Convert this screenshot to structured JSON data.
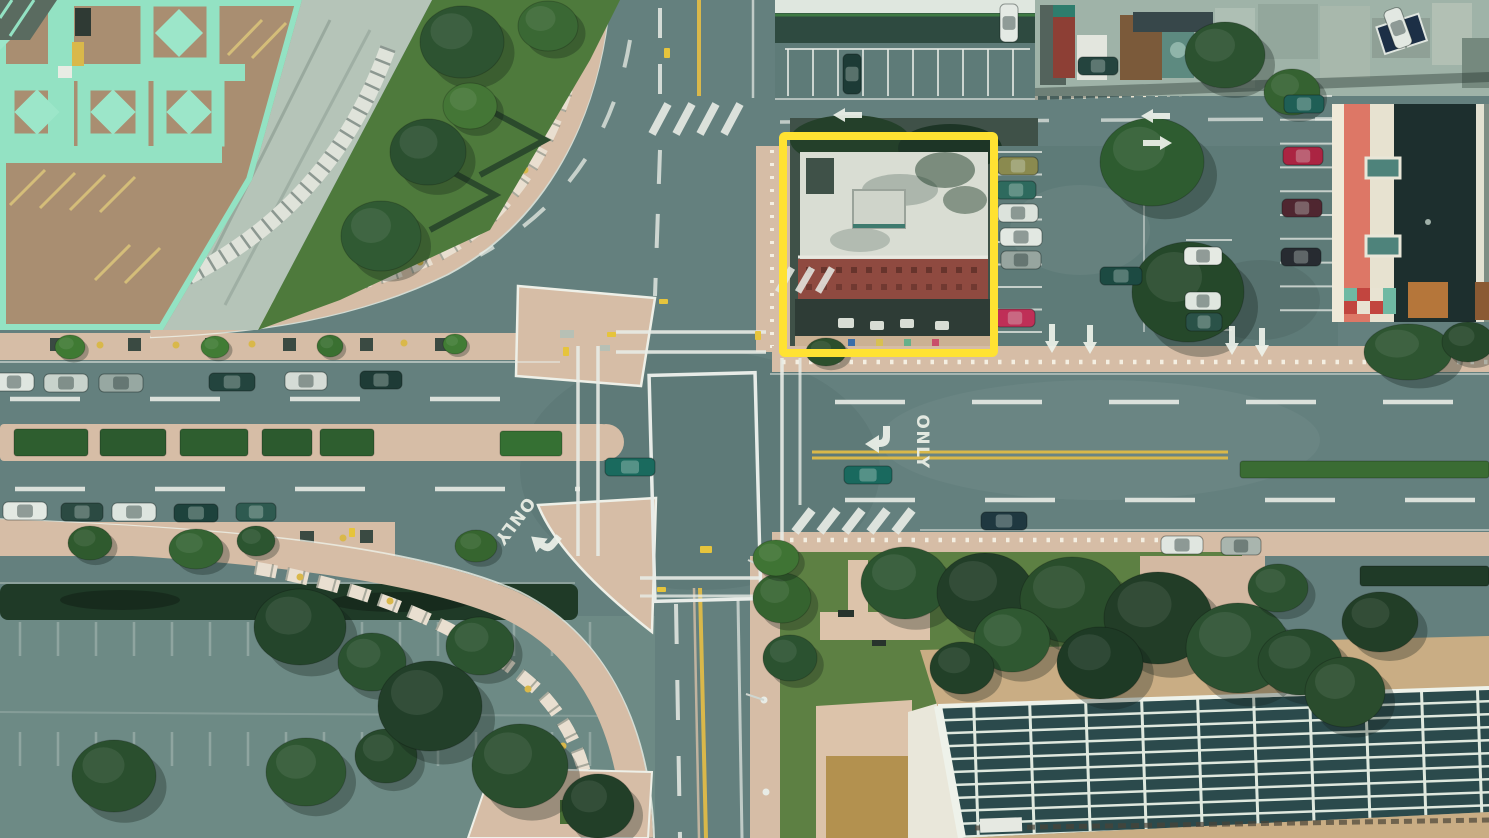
{
  "scene": {
    "description": "Aerial top-down drone photograph of a city street intersection; a building on the north-east corner is outlined with a yellow highlight rectangle",
    "annotation": {
      "label": "highlighted-building",
      "color": "#ffe232",
      "x": 783,
      "y": 136,
      "width": 211,
      "height": 217,
      "stroke_width": 8
    },
    "road_markings": {
      "only_east": "ONLY",
      "only_southwest": "ONLY"
    },
    "palette": {
      "road": "#64807e",
      "road_light": "#6d8a85",
      "asphalt_lot": "#5e7b78",
      "sidewalk": "#d6bda6",
      "deck_tan": "#a98e71",
      "deck_mint": "#93e2c3",
      "lawn": "#5d8043",
      "hedge_dark": "#1f3a27",
      "panel_roof": "#2b4a4c",
      "panel_grid": "#dfe9df",
      "brick_red": "#8f4a40",
      "coral": "#dd7766",
      "cream": "#e7e2d0",
      "dark_roof": "#1d2f2e",
      "white_roof": "#d9ddd3",
      "yellow_line": "#d9b84a",
      "white_line": "#edf1e8"
    },
    "cars": [
      {
        "x": 14,
        "y": 382,
        "a": 0,
        "c": "#dfe6e0",
        "l": 40
      },
      {
        "x": 66,
        "y": 383,
        "a": 0,
        "c": "#c8d3cc",
        "l": 44
      },
      {
        "x": 121,
        "y": 383,
        "a": 0,
        "c": "#97a8a2",
        "l": 44
      },
      {
        "x": 232,
        "y": 382,
        "a": 0,
        "c": "#23443e",
        "l": 46
      },
      {
        "x": 306,
        "y": 381,
        "a": 0,
        "c": "#d5dcd6",
        "l": 42
      },
      {
        "x": 381,
        "y": 380,
        "a": 0,
        "c": "#1e3b36",
        "l": 42
      },
      {
        "x": 25,
        "y": 511,
        "a": 0,
        "c": "#e3e9e3",
        "l": 44
      },
      {
        "x": 82,
        "y": 512,
        "a": 0,
        "c": "#2b4a42",
        "l": 42
      },
      {
        "x": 134,
        "y": 512,
        "a": 0,
        "c": "#dde5df",
        "l": 44
      },
      {
        "x": 196,
        "y": 513,
        "a": 0,
        "c": "#1d423c",
        "l": 44
      },
      {
        "x": 256,
        "y": 512,
        "a": 0,
        "c": "#2e5a50",
        "l": 40
      },
      {
        "x": 630,
        "y": 467,
        "a": 0,
        "c": "#1a6a5e",
        "l": 50
      },
      {
        "x": 868,
        "y": 475,
        "a": 0,
        "c": "#19695e",
        "l": 48
      },
      {
        "x": 1004,
        "y": 521,
        "a": 0,
        "c": "#1f3840",
        "l": 46
      },
      {
        "x": 1182,
        "y": 545,
        "a": 0,
        "c": "#e0e6e0",
        "l": 42
      },
      {
        "x": 1241,
        "y": 546,
        "a": 0,
        "c": "#a9b5ae",
        "l": 40
      },
      {
        "x": 852,
        "y": 74,
        "a": 90,
        "c": "#1d3b36",
        "l": 40
      },
      {
        "x": 1009,
        "y": 23,
        "a": 90,
        "c": "#e4eae4",
        "l": 38
      },
      {
        "x": 1098,
        "y": 66,
        "a": 0,
        "c": "#24443e",
        "l": 40
      },
      {
        "x": 1398,
        "y": 28,
        "a": 70,
        "c": "#e2e8e2",
        "l": 40
      },
      {
        "x": 1018,
        "y": 166,
        "a": 0,
        "c": "#8a8a4f",
        "l": 40
      },
      {
        "x": 1016,
        "y": 190,
        "a": 0,
        "c": "#2e6a5e",
        "l": 40
      },
      {
        "x": 1018,
        "y": 213,
        "a": 0,
        "c": "#dce3dc",
        "l": 40
      },
      {
        "x": 1021,
        "y": 237,
        "a": 0,
        "c": "#e2e8e2",
        "l": 42
      },
      {
        "x": 1021,
        "y": 260,
        "a": 0,
        "c": "#97a59f",
        "l": 40
      },
      {
        "x": 1015,
        "y": 318,
        "a": 0,
        "c": "#bf2f57",
        "l": 40
      },
      {
        "x": 1121,
        "y": 276,
        "a": 0,
        "c": "#1c4a42",
        "l": 42
      },
      {
        "x": 1203,
        "y": 256,
        "a": 0,
        "c": "#e5eae3",
        "l": 38
      },
      {
        "x": 1203,
        "y": 301,
        "a": 0,
        "c": "#dfe6df",
        "l": 36
      },
      {
        "x": 1204,
        "y": 322,
        "a": 0,
        "c": "#2a5248",
        "l": 36
      },
      {
        "x": 1303,
        "y": 156,
        "a": 0,
        "c": "#ab2442",
        "l": 40
      },
      {
        "x": 1302,
        "y": 208,
        "a": 0,
        "c": "#4f2630",
        "l": 40
      },
      {
        "x": 1304,
        "y": 104,
        "a": 0,
        "c": "#1f5f56",
        "l": 40
      },
      {
        "x": 1301,
        "y": 257,
        "a": 0,
        "c": "#272b31",
        "l": 40
      }
    ],
    "trees": [
      {
        "x": 462,
        "y": 42,
        "rx": 42,
        "ry": 36,
        "c": "#2d5331"
      },
      {
        "x": 548,
        "y": 26,
        "rx": 30,
        "ry": 25,
        "c": "#3a6834"
      },
      {
        "x": 470,
        "y": 106,
        "rx": 27,
        "ry": 23,
        "c": "#447636"
      },
      {
        "x": 428,
        "y": 152,
        "rx": 38,
        "ry": 33,
        "c": "#2b5030"
      },
      {
        "x": 381,
        "y": 236,
        "rx": 40,
        "ry": 35,
        "c": "#305a33"
      },
      {
        "x": 70,
        "y": 347,
        "rx": 15,
        "ry": 12,
        "c": "#3f7a33"
      },
      {
        "x": 215,
        "y": 347,
        "rx": 14,
        "ry": 11,
        "c": "#417c35"
      },
      {
        "x": 330,
        "y": 346,
        "rx": 13,
        "ry": 11,
        "c": "#3a7031"
      },
      {
        "x": 455,
        "y": 344,
        "rx": 12,
        "ry": 10,
        "c": "#417c35"
      },
      {
        "x": 90,
        "y": 543,
        "rx": 22,
        "ry": 17,
        "c": "#2f5a2e"
      },
      {
        "x": 196,
        "y": 549,
        "rx": 27,
        "ry": 20,
        "c": "#356433"
      },
      {
        "x": 256,
        "y": 541,
        "rx": 19,
        "ry": 15,
        "c": "#2c5530"
      },
      {
        "x": 476,
        "y": 546,
        "rx": 21,
        "ry": 16,
        "c": "#36652f"
      },
      {
        "x": 300,
        "y": 627,
        "rx": 46,
        "ry": 38,
        "c": "#24452b"
      },
      {
        "x": 372,
        "y": 662,
        "rx": 34,
        "ry": 29,
        "c": "#2b5230"
      },
      {
        "x": 114,
        "y": 776,
        "rx": 42,
        "ry": 36,
        "c": "#2a4f2e"
      },
      {
        "x": 306,
        "y": 772,
        "rx": 40,
        "ry": 34,
        "c": "#2e5631"
      },
      {
        "x": 386,
        "y": 756,
        "rx": 31,
        "ry": 27,
        "c": "#27492c"
      },
      {
        "x": 480,
        "y": 646,
        "rx": 34,
        "ry": 29,
        "c": "#2c5430"
      },
      {
        "x": 430,
        "y": 706,
        "rx": 52,
        "ry": 45,
        "c": "#223f29"
      },
      {
        "x": 520,
        "y": 766,
        "rx": 48,
        "ry": 42,
        "c": "#2a4e2e"
      },
      {
        "x": 598,
        "y": 806,
        "rx": 36,
        "ry": 32,
        "c": "#223f28"
      },
      {
        "x": 782,
        "y": 598,
        "rx": 29,
        "ry": 25,
        "c": "#35632f"
      },
      {
        "x": 790,
        "y": 658,
        "rx": 27,
        "ry": 23,
        "c": "#2b5230"
      },
      {
        "x": 776,
        "y": 558,
        "rx": 23,
        "ry": 18,
        "c": "#3f7434"
      },
      {
        "x": 826,
        "y": 352,
        "rx": 20,
        "ry": 14,
        "c": "#2c4f2c"
      },
      {
        "x": 905,
        "y": 583,
        "rx": 44,
        "ry": 36,
        "c": "#2c5430"
      },
      {
        "x": 985,
        "y": 593,
        "rx": 48,
        "ry": 40,
        "c": "#223e28"
      },
      {
        "x": 1072,
        "y": 600,
        "rx": 52,
        "ry": 43,
        "c": "#2a4e2c"
      },
      {
        "x": 1158,
        "y": 618,
        "rx": 54,
        "ry": 46,
        "c": "#223d27"
      },
      {
        "x": 1238,
        "y": 648,
        "rx": 52,
        "ry": 45,
        "c": "#2b5030"
      },
      {
        "x": 1100,
        "y": 663,
        "rx": 43,
        "ry": 36,
        "c": "#1e3a25"
      },
      {
        "x": 1012,
        "y": 640,
        "rx": 38,
        "ry": 32,
        "c": "#2f5831"
      },
      {
        "x": 962,
        "y": 668,
        "rx": 32,
        "ry": 26,
        "c": "#224028"
      },
      {
        "x": 1300,
        "y": 662,
        "rx": 42,
        "ry": 33,
        "c": "#274a2c"
      },
      {
        "x": 1380,
        "y": 622,
        "rx": 38,
        "ry": 30,
        "c": "#223e27"
      },
      {
        "x": 1152,
        "y": 162,
        "rx": 52,
        "ry": 44,
        "c": "#2e5c30"
      },
      {
        "x": 1188,
        "y": 292,
        "rx": 56,
        "ry": 50,
        "c": "#25482a"
      },
      {
        "x": 1225,
        "y": 55,
        "rx": 40,
        "ry": 33,
        "c": "#2c5230"
      },
      {
        "x": 1292,
        "y": 92,
        "rx": 28,
        "ry": 23,
        "c": "#356231"
      },
      {
        "x": 1408,
        "y": 352,
        "rx": 44,
        "ry": 28,
        "c": "#2e5531"
      },
      {
        "x": 1468,
        "y": 342,
        "rx": 26,
        "ry": 20,
        "c": "#27482b"
      },
      {
        "x": 1345,
        "y": 692,
        "rx": 40,
        "ry": 35,
        "c": "#2a4c2d"
      },
      {
        "x": 1278,
        "y": 588,
        "rx": 30,
        "ry": 24,
        "c": "#2c5230"
      }
    ],
    "hedges": [
      {
        "x": 14,
        "y": 429,
        "w": 74,
        "h": 27,
        "c": "#2e5e2f"
      },
      {
        "x": 100,
        "y": 429,
        "w": 66,
        "h": 27,
        "c": "#2c5a2e"
      },
      {
        "x": 180,
        "y": 429,
        "w": 68,
        "h": 27,
        "c": "#2e5e2f"
      },
      {
        "x": 262,
        "y": 429,
        "w": 50,
        "h": 27,
        "c": "#2c5a2e"
      },
      {
        "x": 320,
        "y": 429,
        "w": 54,
        "h": 27,
        "c": "#2e5e2f"
      },
      {
        "x": 500,
        "y": 431,
        "w": 62,
        "h": 25,
        "c": "#357033"
      },
      {
        "x": 1240,
        "y": 461,
        "w": 249,
        "h": 17,
        "c": "#3a6c33"
      },
      {
        "x": 1360,
        "y": 566,
        "w": 129,
        "h": 20,
        "c": "#1f3a27"
      }
    ],
    "arrows": [
      {
        "x": 1156,
        "y": 116,
        "a": 270,
        "t": "straight"
      },
      {
        "x": 848,
        "y": 115,
        "a": 270,
        "t": "straight"
      },
      {
        "x": 1157,
        "y": 143,
        "a": 90,
        "t": "straight"
      },
      {
        "x": 1052,
        "y": 338,
        "a": 180,
        "t": "straight"
      },
      {
        "x": 1090,
        "y": 339,
        "a": 180,
        "t": "straight"
      },
      {
        "x": 1232,
        "y": 340,
        "a": 180,
        "t": "straight"
      },
      {
        "x": 1262,
        "y": 342,
        "a": 180,
        "t": "straight"
      },
      {
        "x": 874,
        "y": 441,
        "a": 0,
        "t": "turn"
      },
      {
        "x": 540,
        "y": 540,
        "a": 40,
        "t": "turn"
      }
    ]
  }
}
